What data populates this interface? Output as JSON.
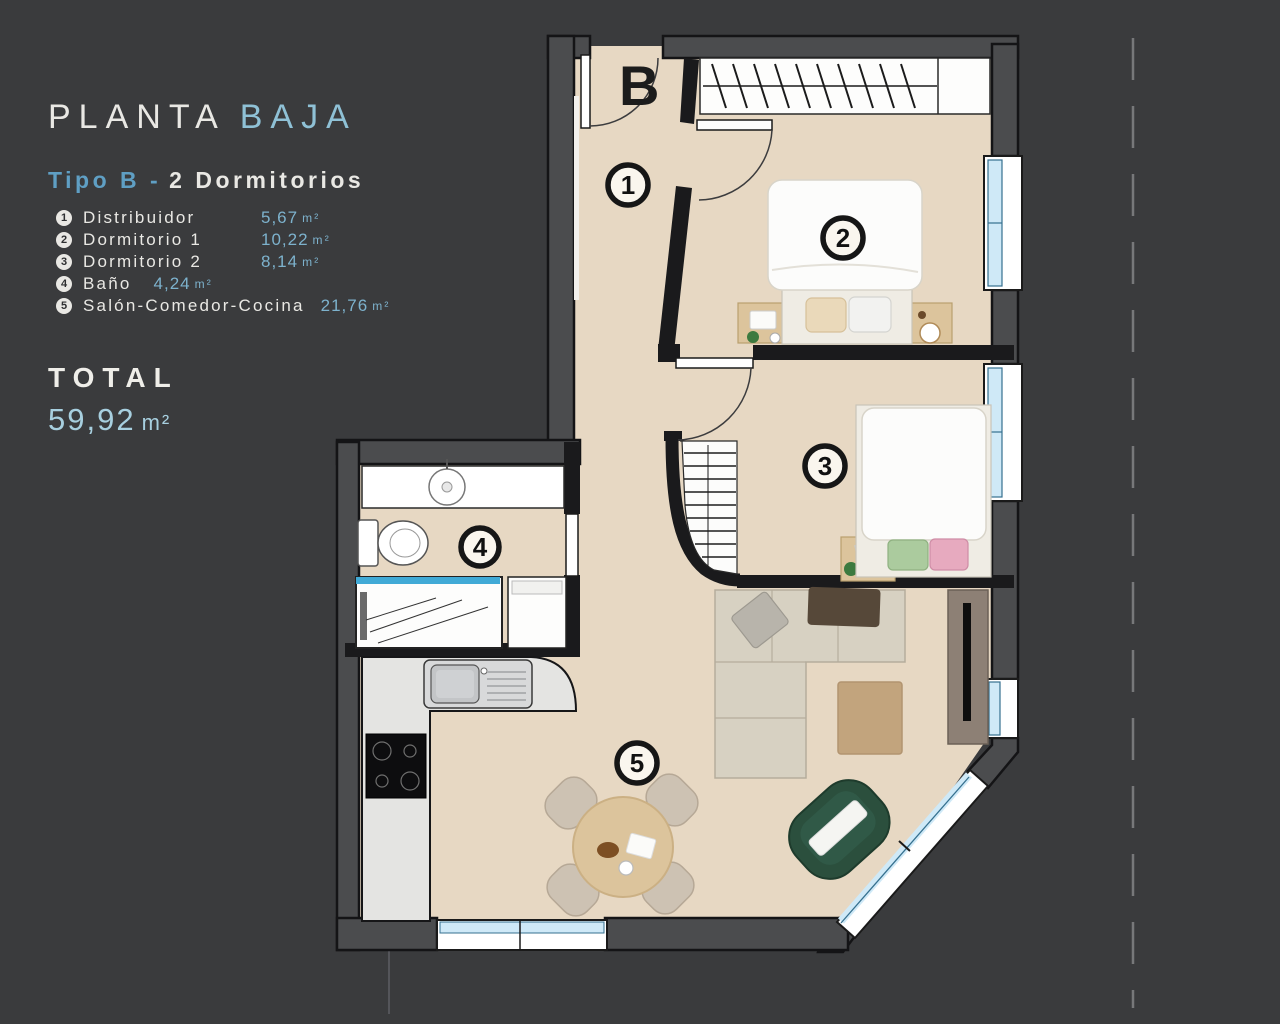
{
  "panel": {
    "title": {
      "word1": "PLANTA",
      "word2": "BAJA"
    },
    "subtitle": {
      "highlight": "Tipo B -",
      "rest": "2 Dormitorios"
    },
    "legend": [
      {
        "num": "1",
        "name": "Distribuidor",
        "value": "5,67",
        "unit": "m²"
      },
      {
        "num": "2",
        "name": "Dormitorio 1",
        "value": "10,22",
        "unit": "m²"
      },
      {
        "num": "3",
        "name": "Dormitorio 2",
        "value": "8,14",
        "unit": "m²"
      },
      {
        "num": "4",
        "name": "Baño",
        "value": "4,24",
        "unit": "m²"
      },
      {
        "num": "5",
        "name": "Salón-Comedor-Cocina",
        "value": "21,76",
        "unit": "m²"
      }
    ],
    "total": {
      "label": "TOTAL",
      "value": "59,92",
      "unit": "m²"
    }
  },
  "plan": {
    "entrance_label": "B",
    "room_markers": [
      {
        "num": "1"
      },
      {
        "num": "2"
      },
      {
        "num": "3"
      },
      {
        "num": "4"
      },
      {
        "num": "5"
      }
    ],
    "colors": {
      "background": "#3a3b3d",
      "accent_blue": "#7db2cd",
      "title_blue": "#8fc1d6",
      "floor": "#e7d8c3",
      "wall_gray": "#4b4c4e",
      "wall_black": "#1a1a1c",
      "window_glass": "#cfe9f7",
      "shower_glass": "#41aad6",
      "counter": "#e4e4e2",
      "wood": "#dcc49c",
      "sofa": "#d7d1c2",
      "armchair_green": "#2b4f3d",
      "pouf": "#c2a47d"
    }
  }
}
